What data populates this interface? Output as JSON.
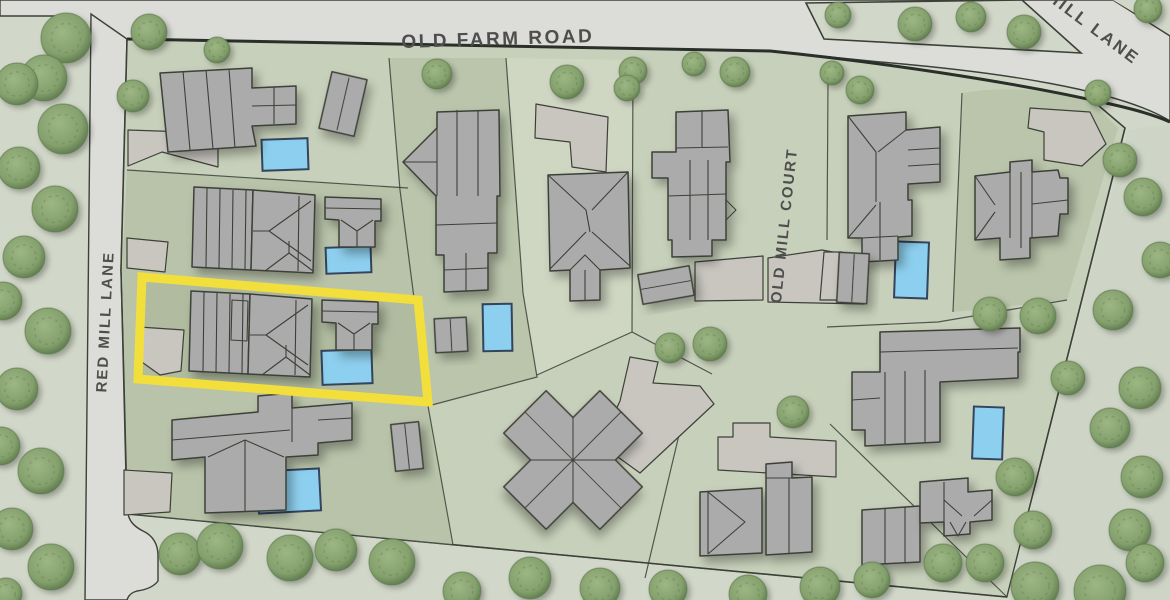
{
  "map_title": "Residential parcel map with highlighted lot",
  "streets": {
    "old_farm": "OLD FARM ROAD",
    "red_mill": "RED MILL LANE",
    "old_mill": "OLD MILL COURT",
    "hill": "HILL LANE"
  },
  "highlighted_parcel": {
    "name": "selected-parcel",
    "stroke_width": 9
  },
  "theme": {
    "pavement": "#dcddd9",
    "outside_green": "#d2d8c9",
    "block_green": "#c7d0ba",
    "parcel_dark": "#b9c3a9",
    "parcel_darker": "#b0bb9f",
    "parcel_mid": "#bac5ab",
    "parcel_light": "#cfd6c2",
    "woods_green": "#ced5c6",
    "building": "#ababab",
    "building_light": "#c9c6c0",
    "outline": "#3c4138",
    "pool_fill": "#8dcfee",
    "pool_stroke": "#33445c",
    "tree_core": "#9db784",
    "tree_fill": "#84a06c",
    "tree_edge": "#5e7a4e",
    "highlight": "#f2df3c",
    "label_color": "#4e4e4e"
  },
  "features": {
    "pools": [
      {
        "x": 262,
        "y": 139,
        "w": 46,
        "h": 31,
        "rot": -2
      },
      {
        "x": 326,
        "y": 247,
        "w": 45,
        "h": 26,
        "rot": -2
      },
      {
        "x": 322,
        "y": 350,
        "w": 50,
        "h": 34,
        "rot": -2
      },
      {
        "x": 258,
        "y": 470,
        "w": 62,
        "h": 42,
        "rot": -3
      },
      {
        "x": 483,
        "y": 304,
        "w": 29,
        "h": 47,
        "rot": -1
      },
      {
        "x": 895,
        "y": 242,
        "w": 33,
        "h": 56,
        "rot": 2
      },
      {
        "x": 973,
        "y": 407,
        "w": 30,
        "h": 52,
        "rot": 2
      }
    ],
    "trees": [
      {
        "x": 66,
        "y": 38,
        "r": 25
      },
      {
        "x": 44,
        "y": 78,
        "r": 23
      },
      {
        "x": 17,
        "y": 84,
        "r": 21
      },
      {
        "x": 63,
        "y": 129,
        "r": 25
      },
      {
        "x": 19,
        "y": 168,
        "r": 21
      },
      {
        "x": 55,
        "y": 209,
        "r": 23
      },
      {
        "x": 24,
        "y": 257,
        "r": 21
      },
      {
        "x": 3,
        "y": 301,
        "r": 19
      },
      {
        "x": 48,
        "y": 331,
        "r": 23
      },
      {
        "x": 17,
        "y": 389,
        "r": 21
      },
      {
        "x": 1,
        "y": 446,
        "r": 19
      },
      {
        "x": 41,
        "y": 471,
        "r": 23
      },
      {
        "x": 12,
        "y": 529,
        "r": 21
      },
      {
        "x": 51,
        "y": 567,
        "r": 23
      },
      {
        "x": 6,
        "y": 594,
        "r": 16
      },
      {
        "x": 149,
        "y": 32,
        "r": 18
      },
      {
        "x": 133,
        "y": 96,
        "r": 16
      },
      {
        "x": 217,
        "y": 50,
        "r": 13
      },
      {
        "x": 437,
        "y": 74,
        "r": 15
      },
      {
        "x": 567,
        "y": 82,
        "r": 17
      },
      {
        "x": 633,
        "y": 71,
        "r": 14
      },
      {
        "x": 694,
        "y": 64,
        "r": 12
      },
      {
        "x": 735,
        "y": 72,
        "r": 15
      },
      {
        "x": 838,
        "y": 15,
        "r": 13
      },
      {
        "x": 915,
        "y": 24,
        "r": 17
      },
      {
        "x": 971,
        "y": 17,
        "r": 15
      },
      {
        "x": 1024,
        "y": 32,
        "r": 17
      },
      {
        "x": 1148,
        "y": 9,
        "r": 14
      },
      {
        "x": 832,
        "y": 73,
        "r": 12
      },
      {
        "x": 860,
        "y": 90,
        "r": 14
      },
      {
        "x": 627,
        "y": 88,
        "r": 13
      },
      {
        "x": 670,
        "y": 348,
        "r": 15
      },
      {
        "x": 710,
        "y": 344,
        "r": 17
      },
      {
        "x": 793,
        "y": 412,
        "r": 16
      },
      {
        "x": 990,
        "y": 314,
        "r": 17
      },
      {
        "x": 1038,
        "y": 316,
        "r": 18
      },
      {
        "x": 1120,
        "y": 160,
        "r": 17
      },
      {
        "x": 1143,
        "y": 197,
        "r": 19
      },
      {
        "x": 1160,
        "y": 260,
        "r": 18
      },
      {
        "x": 1098,
        "y": 93,
        "r": 13
      },
      {
        "x": 1113,
        "y": 310,
        "r": 20
      },
      {
        "x": 1068,
        "y": 378,
        "r": 17
      },
      {
        "x": 1140,
        "y": 388,
        "r": 21
      },
      {
        "x": 1110,
        "y": 428,
        "r": 20
      },
      {
        "x": 1015,
        "y": 477,
        "r": 19
      },
      {
        "x": 1142,
        "y": 477,
        "r": 21
      },
      {
        "x": 1033,
        "y": 530,
        "r": 19
      },
      {
        "x": 1130,
        "y": 530,
        "r": 21
      },
      {
        "x": 985,
        "y": 563,
        "r": 19
      },
      {
        "x": 1145,
        "y": 563,
        "r": 19
      },
      {
        "x": 943,
        "y": 563,
        "r": 19
      },
      {
        "x": 180,
        "y": 554,
        "r": 21
      },
      {
        "x": 220,
        "y": 546,
        "r": 23
      },
      {
        "x": 290,
        "y": 558,
        "r": 23
      },
      {
        "x": 336,
        "y": 550,
        "r": 21
      },
      {
        "x": 392,
        "y": 562,
        "r": 23
      },
      {
        "x": 462,
        "y": 591,
        "r": 19
      },
      {
        "x": 530,
        "y": 578,
        "r": 21
      },
      {
        "x": 600,
        "y": 588,
        "r": 20
      },
      {
        "x": 668,
        "y": 589,
        "r": 19
      },
      {
        "x": 748,
        "y": 594,
        "r": 19
      },
      {
        "x": 820,
        "y": 587,
        "r": 20
      },
      {
        "x": 872,
        "y": 580,
        "r": 18
      },
      {
        "x": 1035,
        "y": 586,
        "r": 24
      },
      {
        "x": 1100,
        "y": 591,
        "r": 26
      }
    ]
  }
}
